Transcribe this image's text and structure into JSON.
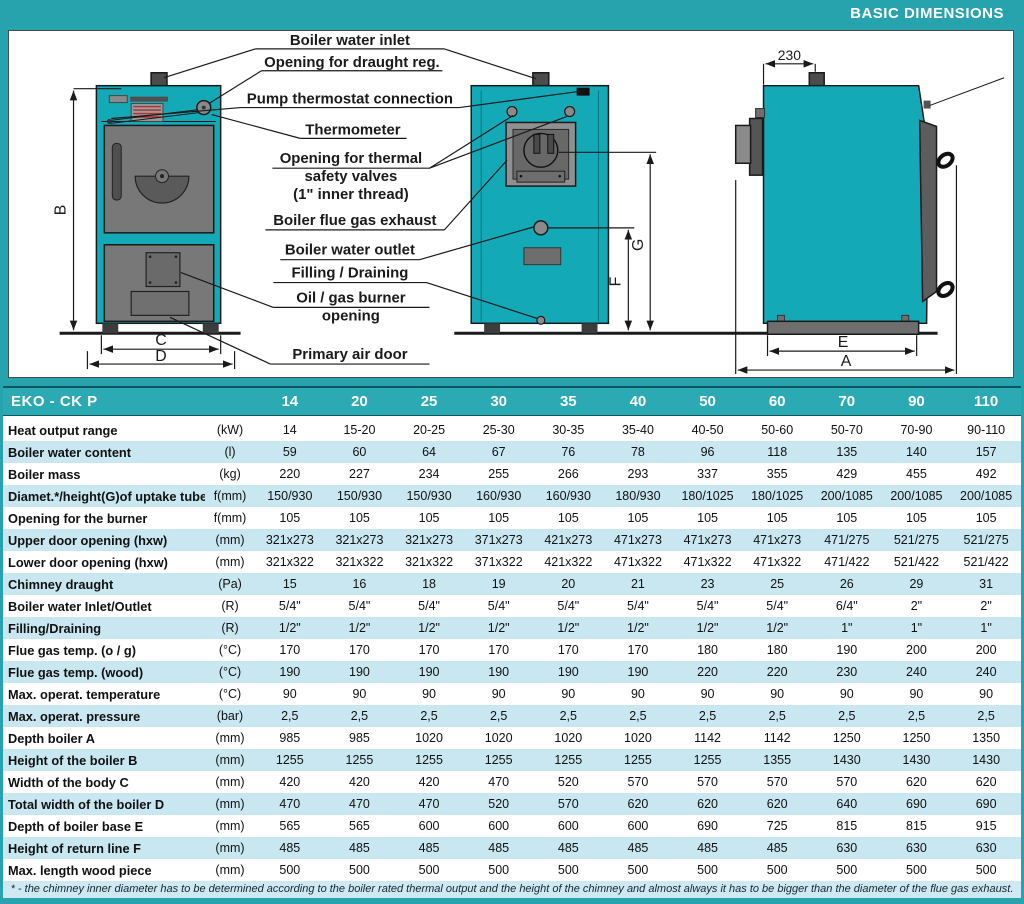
{
  "header": {
    "title": "BASIC DIMENSIONS"
  },
  "colors": {
    "teal_background": "#26a3ad",
    "table_header": "#2caab3",
    "row_alternate": "#c9e7f0",
    "boiler_fill": "#14a9b7",
    "footnote_bg": "#cfe9f2"
  },
  "diagram": {
    "callouts": {
      "water_inlet": "Boiler water inlet",
      "draught_reg": "Opening for draught reg.",
      "pump_thermostat": "Pump thermostat connection",
      "thermometer": "Thermometer",
      "thermal_safety_line1": "Opening for thermal",
      "thermal_safety_line2": "safety valves",
      "thermal_safety_line3": "(1\" inner thread)",
      "flue_exhaust": "Boiler flue gas exhaust",
      "water_outlet": "Boiler water outlet",
      "filling_draining": "Filling / Draining",
      "burner_line1": "Oil / gas burner",
      "burner_line2": "opening",
      "primary_air_door": "Primary air door"
    },
    "dimensions": {
      "height_b": "B",
      "width_c": "C",
      "width_d": "D",
      "return_f": "F",
      "uptake_g": "G",
      "base_e": "E",
      "depth_a": "A",
      "top_offset": "230"
    }
  },
  "table": {
    "model_label": "EKO - CK P",
    "columns": [
      "14",
      "20",
      "25",
      "30",
      "35",
      "40",
      "50",
      "60",
      "70",
      "90",
      "110"
    ],
    "rows": [
      {
        "label": "Heat output range",
        "unit": "(kW)",
        "values": [
          "14",
          "15-20",
          "20-25",
          "25-30",
          "30-35",
          "35-40",
          "40-50",
          "50-60",
          "50-70",
          "70-90",
          "90-110"
        ]
      },
      {
        "label": "Boiler water content",
        "unit": "(l)",
        "values": [
          "59",
          "60",
          "64",
          "67",
          "76",
          "78",
          "96",
          "118",
          "135",
          "140",
          "157"
        ]
      },
      {
        "label": "Boiler mass",
        "unit": "(kg)",
        "values": [
          "220",
          "227",
          "234",
          "255",
          "266",
          "293",
          "337",
          "355",
          "429",
          "455",
          "492"
        ]
      },
      {
        "label": "Diamet.*/height(G)of uptake tube",
        "unit": "f(mm)",
        "values": [
          "150/930",
          "150/930",
          "150/930",
          "160/930",
          "160/930",
          "180/930",
          "180/1025",
          "180/1025",
          "200/1085",
          "200/1085",
          "200/1085"
        ]
      },
      {
        "label": "Opening for the burner",
        "unit": "f(mm)",
        "values": [
          "105",
          "105",
          "105",
          "105",
          "105",
          "105",
          "105",
          "105",
          "105",
          "105",
          "105"
        ]
      },
      {
        "label": "Upper door opening (hxw)",
        "unit": "(mm)",
        "values": [
          "321x273",
          "321x273",
          "321x273",
          "371x273",
          "421x273",
          "471x273",
          "471x273",
          "471x273",
          "471/275",
          "521/275",
          "521/275"
        ]
      },
      {
        "label": "Lower door opening (hxw)",
        "unit": "(mm)",
        "values": [
          "321x322",
          "321x322",
          "321x322",
          "371x322",
          "421x322",
          "471x322",
          "471x322",
          "471x322",
          "471/422",
          "521/422",
          "521/422"
        ]
      },
      {
        "label": "Chimney draught",
        "unit": "(Pa)",
        "values": [
          "15",
          "16",
          "18",
          "19",
          "20",
          "21",
          "23",
          "25",
          "26",
          "29",
          "31"
        ]
      },
      {
        "label": "Boiler water Inlet/Outlet",
        "unit": "(R)",
        "values": [
          "5/4\"",
          "5/4\"",
          "5/4\"",
          "5/4\"",
          "5/4\"",
          "5/4\"",
          "5/4\"",
          "5/4\"",
          "6/4\"",
          "2\"",
          "2\""
        ]
      },
      {
        "label": "Filling/Draining",
        "unit": "(R)",
        "values": [
          "1/2\"",
          "1/2\"",
          "1/2\"",
          "1/2\"",
          "1/2\"",
          "1/2\"",
          "1/2\"",
          "1/2\"",
          "1\"",
          "1\"",
          "1\""
        ]
      },
      {
        "label": "Flue gas temp. (o / g)",
        "unit": "(°C)",
        "values": [
          "170",
          "170",
          "170",
          "170",
          "170",
          "170",
          "180",
          "180",
          "190",
          "200",
          "200"
        ]
      },
      {
        "label": "Flue gas temp. (wood)",
        "unit": "(°C)",
        "values": [
          "190",
          "190",
          "190",
          "190",
          "190",
          "190",
          "220",
          "220",
          "230",
          "240",
          "240"
        ]
      },
      {
        "label": "Max. operat. temperature",
        "unit": "(°C)",
        "values": [
          "90",
          "90",
          "90",
          "90",
          "90",
          "90",
          "90",
          "90",
          "90",
          "90",
          "90"
        ]
      },
      {
        "label": "Max. operat. pressure",
        "unit": "(bar)",
        "values": [
          "2,5",
          "2,5",
          "2,5",
          "2,5",
          "2,5",
          "2,5",
          "2,5",
          "2,5",
          "2,5",
          "2,5",
          "2,5"
        ]
      },
      {
        "label": "Depth boiler A",
        "unit": "(mm)",
        "values": [
          "985",
          "985",
          "1020",
          "1020",
          "1020",
          "1020",
          "1142",
          "1142",
          "1250",
          "1250",
          "1350"
        ]
      },
      {
        "label": "Height of the boiler B",
        "unit": "(mm)",
        "values": [
          "1255",
          "1255",
          "1255",
          "1255",
          "1255",
          "1255",
          "1255",
          "1355",
          "1430",
          "1430",
          "1430"
        ]
      },
      {
        "label": "Width of the body C",
        "unit": "(mm)",
        "values": [
          "420",
          "420",
          "420",
          "470",
          "520",
          "570",
          "570",
          "570",
          "570",
          "620",
          "620"
        ]
      },
      {
        "label": "Total width of the boiler D",
        "unit": "(mm)",
        "values": [
          "470",
          "470",
          "470",
          "520",
          "570",
          "620",
          "620",
          "620",
          "640",
          "690",
          "690"
        ]
      },
      {
        "label": "Depth of boiler base E",
        "unit": "(mm)",
        "values": [
          "565",
          "565",
          "600",
          "600",
          "600",
          "600",
          "690",
          "725",
          "815",
          "815",
          "915"
        ]
      },
      {
        "label": "Height of return line F",
        "unit": "(mm)",
        "values": [
          "485",
          "485",
          "485",
          "485",
          "485",
          "485",
          "485",
          "485",
          "630",
          "630",
          "630"
        ]
      },
      {
        "label": "Max. length wood piece",
        "unit": "(mm)",
        "values": [
          "500",
          "500",
          "500",
          "500",
          "500",
          "500",
          "500",
          "500",
          "500",
          "500",
          "500"
        ]
      }
    ],
    "footnote": "* - the chimney inner diameter has to be determined according to the boiler rated thermal output and the height of the chimney and almost always it has to be bigger than the diameter of the flue gas exhaust."
  }
}
